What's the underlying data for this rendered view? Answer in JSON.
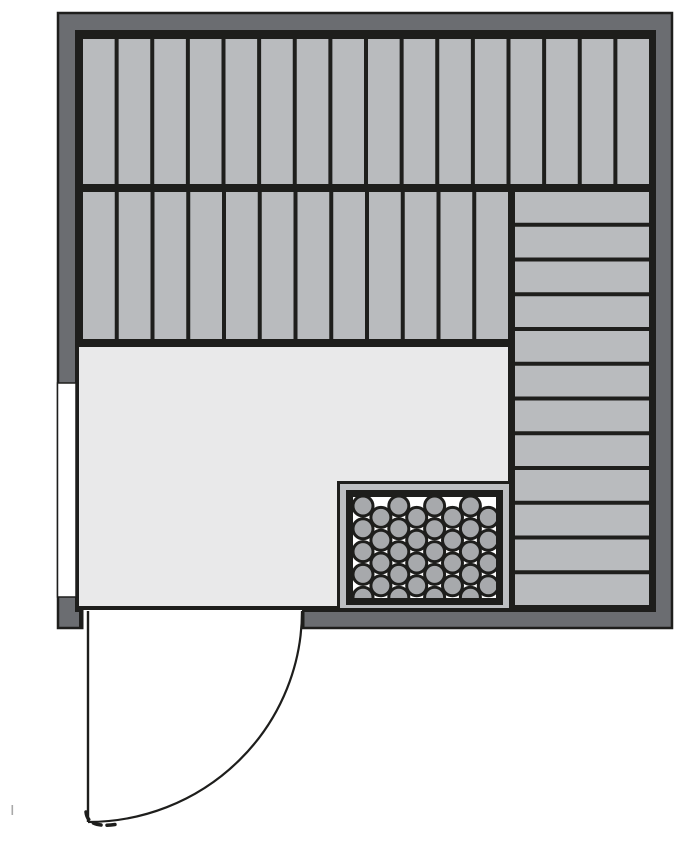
{
  "plan": {
    "description": "sauna floor plan, top-down view",
    "canvas": {
      "w": 697,
      "h": 845
    },
    "colors": {
      "background": "#ffffff",
      "wall": "#6b6d71",
      "line": "#1e1e1c",
      "plank": "#b9bbbe",
      "floor": "#e9e9ea",
      "heater_ring": "#bdbfc2",
      "stone": "#a7a9ac",
      "stone_bed": "#ffffff",
      "window": "#ffffff",
      "stray": "#a8a8a8"
    },
    "outer_wall": {
      "x": 58,
      "y": 13,
      "w": 614,
      "h": 615,
      "stroke_w": 2.5
    },
    "frame": {
      "x": 75,
      "y": 30,
      "w": 581,
      "h": 582
    },
    "benches": [
      {
        "id": "upper-bench-row-1",
        "orientation": "vertical",
        "x": 83,
        "y": 39,
        "w": 566,
        "h": 145,
        "planks": 16,
        "gap": 4
      },
      {
        "id": "upper-bench-row-2",
        "orientation": "vertical",
        "x": 83,
        "y": 192,
        "w": 425,
        "h": 147,
        "planks": 12,
        "gap": 4
      },
      {
        "id": "right-bench",
        "orientation": "horizontal",
        "x": 515,
        "y": 192,
        "w": 134,
        "h": 413,
        "planks": 12,
        "gap": 4
      }
    ],
    "floor": {
      "x": 79,
      "y": 347,
      "w": 429,
      "h": 259
    },
    "window": {
      "x": 57.5,
      "y": 383,
      "w": 18.5,
      "h": 214,
      "stroke_w": 1.5
    },
    "heater": {
      "outer": {
        "x": 337,
        "y": 481,
        "w": 175,
        "h": 130
      },
      "ring": {
        "x": 340,
        "y": 484,
        "w": 169,
        "h": 124
      },
      "inner": {
        "x": 346,
        "y": 490,
        "w": 157,
        "h": 115
      },
      "bed": {
        "x": 353,
        "y": 497,
        "w": 143,
        "h": 101
      },
      "stones": {
        "x0": 363,
        "cols": 8,
        "col_pitch": 17.9,
        "row_pitch": 22.8,
        "even_y0": 506,
        "even_rows": 5,
        "odd_y0": 517.4,
        "odd_rows": 4,
        "r": 10,
        "stroke_w": 3
      }
    },
    "door": {
      "opening": {
        "x": 83.5,
        "y": 610,
        "w": 218.5,
        "h": 20
      },
      "jamb_left": {
        "x": 79,
        "y": 610,
        "w": 4.5,
        "h": 18
      },
      "jamb_right": {
        "x": 302,
        "y": 610,
        "w": 2.5,
        "h": 18
      },
      "leaf": {
        "x": 88,
        "y1": 611,
        "y2": 822,
        "stroke_w": 2.4
      },
      "arc": {
        "cx": 88,
        "cy": 611,
        "rx": 214,
        "ry": 211,
        "stroke_w": 2.2
      },
      "rough": {
        "d": "M 86 812 C 87 822 95 828 118 824",
        "stroke_w": 3.5,
        "dash": "8 6"
      }
    },
    "stray_mark": {
      "x": 11.5,
      "y": 805,
      "w": 1.6,
      "h": 10
    }
  }
}
